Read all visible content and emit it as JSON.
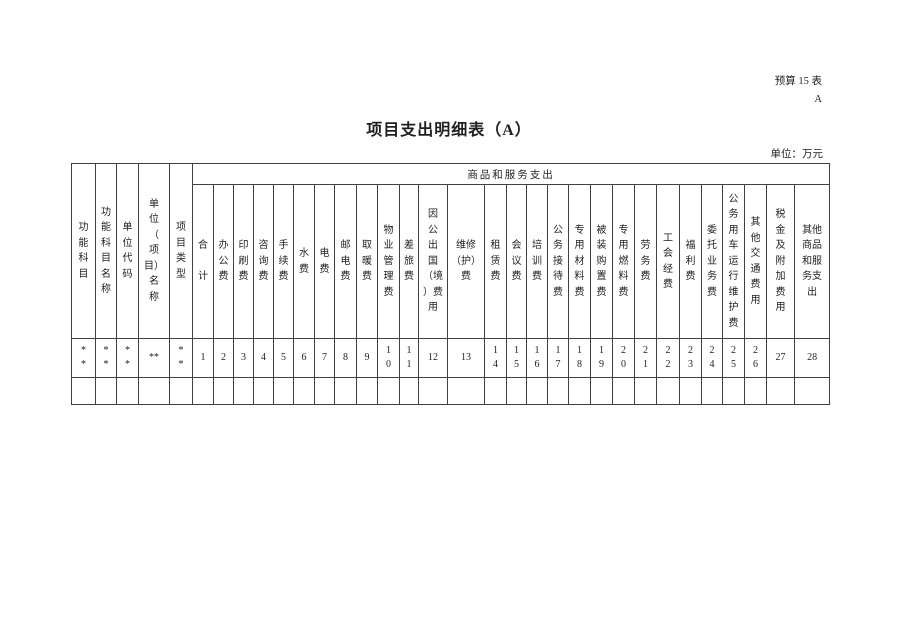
{
  "page": {
    "form_code_line1": "预算 15 表",
    "form_code_line2": "A",
    "title": "项目支出明细表（A）",
    "unit_note": "单位：万元"
  },
  "table": {
    "group_header": "商品和服务支出",
    "fixed_columns": [
      {
        "label": "功\n能\n科\n目",
        "value": "*\n*"
      },
      {
        "label": "功\n能\n科\n目\n名\n称",
        "value": "*\n*"
      },
      {
        "label": "单\n位\n代\n码",
        "value": "*\n*"
      },
      {
        "label": "单\n位\n（\n项\n目）\n名\n称",
        "value": "**"
      },
      {
        "label": "项\n目\n类\n型",
        "value": "*\n*"
      }
    ],
    "expense_columns": [
      {
        "label": "合\n\n计",
        "num": "1"
      },
      {
        "label": "办\n公\n费",
        "num": "2"
      },
      {
        "label": "印\n刷\n费",
        "num": "3"
      },
      {
        "label": "咨\n询\n费",
        "num": "4"
      },
      {
        "label": "手\n续\n费",
        "num": "5"
      },
      {
        "label": "水\n费",
        "num": "6"
      },
      {
        "label": "电\n费",
        "num": "7"
      },
      {
        "label": "邮\n电\n费",
        "num": "8"
      },
      {
        "label": "取\n暖\n费",
        "num": "9"
      },
      {
        "label": "物\n业\n管\n理\n费",
        "num": "1\n0"
      },
      {
        "label": "差\n旅\n费",
        "num": "1\n1"
      },
      {
        "label": "因\n公\n出\n国\n（境\n）费\n用",
        "num": "12"
      },
      {
        "label": "维修\n（护）\n费",
        "num": "13"
      },
      {
        "label": "租\n赁\n费",
        "num": "1\n4"
      },
      {
        "label": "会\n议\n费",
        "num": "1\n5"
      },
      {
        "label": "培\n训\n费",
        "num": "1\n6"
      },
      {
        "label": "公\n务\n接\n待\n费",
        "num": "1\n7"
      },
      {
        "label": "专\n用\n材\n料\n费",
        "num": "1\n8"
      },
      {
        "label": "被\n装\n购\n置\n费",
        "num": "1\n9"
      },
      {
        "label": "专\n用\n燃\n料\n费",
        "num": "2\n0"
      },
      {
        "label": "劳\n务\n费",
        "num": "2\n1"
      },
      {
        "label": "工\n会\n经\n费",
        "num": "2\n2"
      },
      {
        "label": "福\n利\n费",
        "num": "2\n3"
      },
      {
        "label": "委\n托\n业\n务\n费",
        "num": "2\n4"
      },
      {
        "label": "公\n务\n用\n车\n运\n行\n维\n护\n费",
        "num": "2\n5"
      },
      {
        "label": "其\n他\n交\n通\n费\n用",
        "num": "2\n6"
      },
      {
        "label": "税\n金\n及\n附\n加\n费\n用",
        "num": "27"
      },
      {
        "label": "其他\n商品\n和服\n务支\n出",
        "num": "28"
      }
    ]
  }
}
